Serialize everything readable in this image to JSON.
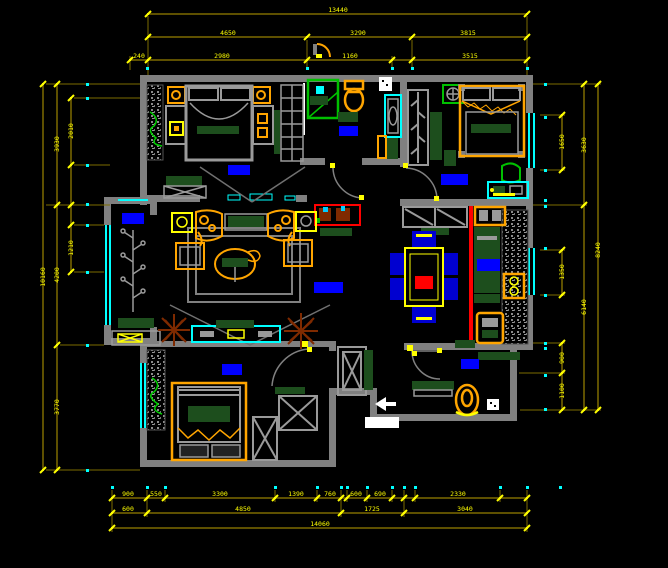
{
  "drawing": {
    "type": "apartment-floor-plan",
    "background": "#000000"
  },
  "colors": {
    "wall": "#808080",
    "wall_light": "#9a9a9a",
    "window": "#00ffff",
    "dim_line": "#7d6b00",
    "dim_mark": "#ffff00",
    "dim_text": "#ffff00",
    "label_blue": "#0000ff",
    "chair_blue": "#0000d0",
    "furniture_orange": "#ffa500",
    "furniture_yellow": "#ffff00",
    "dark_green": "#1d4e1d",
    "bright_green": "#00c000",
    "plant_green": "#00d000",
    "red": "#ff0000",
    "plant_brown": "#7f2a00",
    "white": "#ffffff"
  },
  "rooms": [
    {
      "id": "bedroom-top-left",
      "x": 228,
      "y": 165,
      "w": 22,
      "h": 10
    },
    {
      "id": "bathroom",
      "x": 339,
      "y": 126,
      "w": 19,
      "h": 10
    },
    {
      "id": "bedroom-top-right",
      "x": 441,
      "y": 174,
      "w": 27,
      "h": 11
    },
    {
      "id": "balcony",
      "x": 122,
      "y": 213,
      "w": 22,
      "h": 11
    },
    {
      "id": "living-room",
      "x": 314,
      "y": 282,
      "w": 29,
      "h": 11
    },
    {
      "id": "kitchen",
      "x": 477,
      "y": 259,
      "w": 23,
      "h": 12
    },
    {
      "id": "bedroom-bottom-left",
      "x": 222,
      "y": 364,
      "w": 20,
      "h": 11
    },
    {
      "id": "entry",
      "x": 461,
      "y": 359,
      "w": 18,
      "h": 10
    }
  ],
  "dimensions": {
    "chains": [
      {
        "dir": "h",
        "pos": 14,
        "from": 148,
        "to": 527,
        "ticks": [
          148,
          527
        ],
        "labels": [
          [
            338,
            "13440"
          ]
        ]
      },
      {
        "dir": "h",
        "pos": 37,
        "from": 148,
        "to": 527,
        "ticks": [
          148,
          307,
          412,
          527
        ],
        "labels": [
          [
            228,
            "4650"
          ],
          [
            358,
            "3290"
          ],
          [
            468,
            "3815"
          ]
        ]
      },
      {
        "dir": "h",
        "pos": 60,
        "from": 130,
        "to": 527,
        "ticks": [
          130,
          148,
          307,
          392,
          412,
          527
        ],
        "labels": [
          [
            139,
            "240"
          ],
          [
            222,
            "2980"
          ],
          [
            350,
            "1160"
          ],
          [
            470,
            "3515"
          ]
        ]
      },
      {
        "dir": "v",
        "pos": 43,
        "from": 84,
        "to": 470,
        "ticks": [
          84,
          470
        ],
        "labels": [
          [
            277,
            "10160"
          ]
        ]
      },
      {
        "dir": "v",
        "pos": 57,
        "from": 84,
        "to": 470,
        "ticks": [
          84,
          205,
          345,
          470
        ],
        "labels": [
          [
            144,
            "3930"
          ],
          [
            275,
            "4200"
          ],
          [
            407,
            "3770"
          ]
        ]
      },
      {
        "dir": "v",
        "pos": 71,
        "from": 98,
        "to": 272,
        "ticks": [
          98,
          165,
          205,
          225,
          272
        ],
        "labels": [
          [
            131,
            "2010"
          ],
          [
            248,
            "1210"
          ]
        ]
      },
      {
        "dir": "v",
        "pos": 598,
        "from": 84,
        "to": 410,
        "ticks": [
          84,
          410
        ],
        "labels": [
          [
            250,
            "8240"
          ]
        ]
      },
      {
        "dir": "v",
        "pos": 584,
        "from": 84,
        "to": 410,
        "ticks": [
          84,
          205,
          410
        ],
        "labels": [
          [
            145,
            "3630"
          ],
          [
            307,
            "6140"
          ]
        ]
      },
      {
        "dir": "v",
        "pos": 562,
        "from": 115,
        "to": 170,
        "ticks": [
          115,
          170
        ],
        "labels": [
          [
            142,
            "1650"
          ]
        ]
      },
      {
        "dir": "v",
        "pos": 562,
        "from": 250,
        "to": 295,
        "ticks": [
          250,
          295
        ],
        "labels": [
          [
            272,
            "1350"
          ]
        ]
      },
      {
        "dir": "v",
        "pos": 562,
        "from": 343,
        "to": 410,
        "ticks": [
          343,
          373,
          410
        ],
        "labels": [
          [
            358,
            "900"
          ],
          [
            391,
            "1100"
          ]
        ]
      },
      {
        "dir": "h",
        "pos": 498,
        "from": 112,
        "to": 527,
        "ticks": [
          112,
          147,
          165,
          275,
          317,
          341,
          347,
          367,
          392,
          404,
          415,
          500,
          527
        ],
        "labels": [
          [
            128,
            "900"
          ],
          [
            156,
            "550"
          ],
          [
            220,
            "3300"
          ],
          [
            296,
            "1390"
          ],
          [
            330,
            "760"
          ],
          [
            356,
            "600"
          ],
          [
            380,
            "690"
          ],
          [
            458,
            "2330"
          ]
        ]
      },
      {
        "dir": "h",
        "pos": 513,
        "from": 112,
        "to": 527,
        "ticks": [
          112,
          147,
          341,
          404,
          527
        ],
        "labels": [
          [
            128,
            "600"
          ],
          [
            243,
            "4850"
          ],
          [
            372,
            "1725"
          ],
          [
            465,
            "3040"
          ]
        ]
      },
      {
        "dir": "h",
        "pos": 528,
        "from": 112,
        "to": 527,
        "ticks": [
          112,
          527
        ],
        "labels": [
          [
            320,
            "14060"
          ]
        ]
      }
    ],
    "ext": [
      [
        148,
        16,
        148,
        75
      ],
      [
        307,
        40,
        307,
        70
      ],
      [
        392,
        56,
        392,
        70
      ],
      [
        412,
        40,
        412,
        70
      ],
      [
        527,
        16,
        527,
        75
      ],
      [
        130,
        56,
        130,
        70
      ],
      [
        46,
        84,
        140,
        84
      ],
      [
        74,
        98,
        140,
        98
      ],
      [
        74,
        165,
        110,
        165
      ],
      [
        46,
        205,
        110,
        205
      ],
      [
        74,
        225,
        104,
        225
      ],
      [
        74,
        272,
        104,
        272
      ],
      [
        60,
        345,
        104,
        345
      ],
      [
        46,
        470,
        140,
        470
      ],
      [
        533,
        84,
        601,
        84
      ],
      [
        540,
        115,
        565,
        115
      ],
      [
        540,
        170,
        565,
        170
      ],
      [
        533,
        205,
        587,
        205
      ],
      [
        540,
        250,
        565,
        250
      ],
      [
        540,
        295,
        565,
        295
      ],
      [
        533,
        343,
        565,
        343
      ],
      [
        519,
        373,
        565,
        373
      ],
      [
        520,
        410,
        601,
        410
      ],
      [
        112,
        490,
        112,
        532
      ],
      [
        147,
        490,
        147,
        517
      ],
      [
        165,
        490,
        165,
        502
      ],
      [
        275,
        490,
        275,
        502
      ],
      [
        317,
        490,
        317,
        502
      ],
      [
        341,
        490,
        341,
        517
      ],
      [
        347,
        490,
        347,
        502
      ],
      [
        367,
        490,
        367,
        502
      ],
      [
        392,
        490,
        392,
        502
      ],
      [
        404,
        490,
        404,
        517
      ],
      [
        415,
        490,
        415,
        502
      ],
      [
        500,
        490,
        500,
        502
      ],
      [
        527,
        490,
        527,
        532
      ]
    ],
    "dots": [
      [
        147,
        68
      ],
      [
        307,
        68
      ],
      [
        392,
        68
      ],
      [
        412,
        68
      ],
      [
        527,
        68
      ],
      [
        87,
        84
      ],
      [
        87,
        98
      ],
      [
        87,
        165
      ],
      [
        87,
        204
      ],
      [
        87,
        225
      ],
      [
        87,
        272
      ],
      [
        87,
        345
      ],
      [
        87,
        470
      ],
      [
        545,
        84
      ],
      [
        545,
        117
      ],
      [
        545,
        170
      ],
      [
        545,
        200
      ],
      [
        545,
        206
      ],
      [
        545,
        248
      ],
      [
        545,
        295
      ],
      [
        545,
        343
      ],
      [
        545,
        348
      ],
      [
        545,
        375
      ],
      [
        545,
        409
      ],
      [
        112,
        487
      ],
      [
        147,
        487
      ],
      [
        165,
        487
      ],
      [
        275,
        487
      ],
      [
        317,
        487
      ],
      [
        341,
        487
      ],
      [
        347,
        487
      ],
      [
        367,
        487
      ],
      [
        392,
        487
      ],
      [
        404,
        487
      ],
      [
        415,
        487
      ],
      [
        500,
        487
      ],
      [
        527,
        487
      ],
      [
        560,
        487
      ]
    ]
  }
}
